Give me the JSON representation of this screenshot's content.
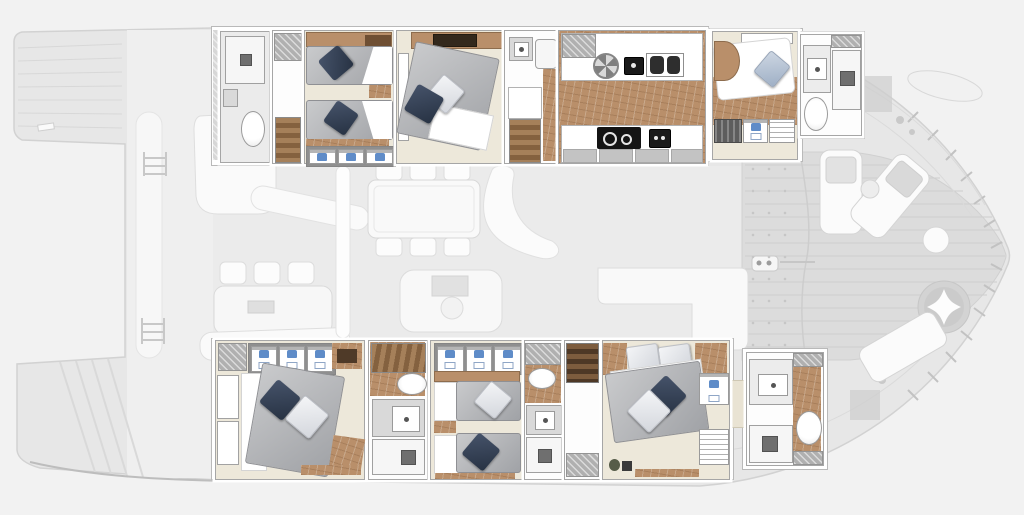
{
  "canvas": {
    "width": 1024,
    "height": 515
  },
  "figure": {
    "kind": "yacht-interior-floor-plan-top-view",
    "vessel": "motor yacht / catamaran deck plan",
    "orientation": "pointed bow at right, wide stern platform at left",
    "highlighted": "cabin-deck strips (upper and lower) rendered in color",
    "ghosted": [
      "stern-platform-wings",
      "side-deck-panel",
      "saloon-deck-center",
      "foredeck-lounge-right"
    ],
    "text_labels": []
  },
  "colors": {
    "background": "#f2f2f2",
    "silhouette": "#e7e7e7",
    "deck_panel": "#efefef",
    "saloon_deck": "#ebebeb",
    "foredeck": "#dcdcdc",
    "ghost_line": "#d2d2d2",
    "ghost_white": "#fafafa",
    "wall": "#a6a6a6",
    "floor_cream": "#ede8da",
    "floor_bath": "#ebebeb",
    "wood": "#b98f6a",
    "wood_dark": "#6f4f33",
    "wood_mid": "#a5805a",
    "sheet": "#ffffff",
    "pillow_dark": "#333e4e",
    "pillow_light": "#e9ebee",
    "pillow_steel": "#b7c3d3",
    "shirt": "#5f8cc8",
    "hatch": "#b0b0b0",
    "appliance": "#1a1a1a",
    "counter_gray": "#c4c4c4",
    "fixture_border": "#9a9a9a"
  },
  "upper_strip": {
    "rooms": [
      {
        "id": "upper-bathroom-fwd",
        "furniture": [
          "shower",
          "washbasin",
          "toilet"
        ]
      },
      {
        "id": "upper-locker-stairs",
        "furniture": [
          "vent-locker",
          "staircase"
        ]
      },
      {
        "id": "upper-twin-cabin",
        "furniture": [
          "headboard-shelf",
          "single-bed",
          "single-bed",
          "nightstand",
          "wardrobe-3-shirts"
        ]
      },
      {
        "id": "upper-double-cabin",
        "furniture": [
          "shelf",
          "tv-unit",
          "window",
          "double-bed",
          "pillows"
        ]
      },
      {
        "id": "upper-shower-stairs",
        "furniture": [
          "washbasin",
          "shower-tray",
          "landing",
          "staircase"
        ]
      },
      {
        "id": "galley",
        "furniture": [
          "worktop",
          "extractor-fan",
          "small-appliance",
          "double-sink",
          "cooktop",
          "oven",
          "cabinet-fronts",
          "wood-floor"
        ]
      },
      {
        "id": "upper-aft-cabin",
        "furniture": [
          "window",
          "double-bed",
          "headboard",
          "dark-locker",
          "shirt-locker",
          "shelf-locker",
          "wood-floor"
        ]
      },
      {
        "id": "upper-aft-bathroom",
        "furniture": [
          "washbasin",
          "toilet",
          "shower"
        ]
      }
    ]
  },
  "lower_strip": {
    "rooms": [
      {
        "id": "owner-cabin",
        "furniture": [
          "vent-locker",
          "wardrobe-3-shirts",
          "wood-cabinet",
          "hull-window",
          "hull-window",
          "double-bed",
          "pillows",
          "desk"
        ]
      },
      {
        "id": "lower-mid-bathroom",
        "furniture": [
          "staircase",
          "toilet",
          "washbasin",
          "shower"
        ]
      },
      {
        "id": "lower-twin-cabin",
        "furniture": [
          "wardrobe-3-shirts",
          "headboard-shelf",
          "single-bed",
          "single-bed",
          "nightstand"
        ]
      },
      {
        "id": "lower-ensuite-wc",
        "furniture": [
          "vent-locker",
          "toilet",
          "washbasin",
          "shower"
        ]
      },
      {
        "id": "lower-stair-lobby",
        "furniture": [
          "staircase",
          "vent-locker"
        ]
      },
      {
        "id": "lower-aft-cabin",
        "furniture": [
          "double-bed",
          "pillows",
          "shirt-locker",
          "shelf-locker",
          "plant",
          "wood-trim"
        ]
      },
      {
        "id": "lower-aft-bathroom",
        "furniture": [
          "washbasin",
          "shower",
          "toilet"
        ]
      }
    ]
  },
  "saloon_ghost": {
    "items": [
      "corner-sofa",
      "sofa-back-band",
      "dinette-chairs-x3",
      "dinette-table",
      "tablet-device",
      "bench-sofa",
      "coachroof-band",
      "boarding-ladder-fwd",
      "boarding-ladder-aft",
      "windshield-band",
      "dining-table",
      "dining-chairs-x6",
      "entry-steps-curve",
      "helm-console",
      "helm-screen",
      "helm-wheel",
      "l-sofa"
    ]
  },
  "foredeck_ghost": {
    "items": [
      "deck-planks",
      "anchor-dots-field",
      "deck-seam",
      "cleat-with-line",
      "sun-lounger-straight",
      "sun-lounger-angled",
      "side-table",
      "pouf",
      "round-chair-star-cushion",
      "sun-lounger-aft",
      "edge-hatch-marks"
    ]
  },
  "stern_ghost": {
    "items": [
      "port-platform-wing",
      "starboard-platform-wing",
      "platform-steps",
      "cleat",
      "transom-edge"
    ]
  },
  "hull_ghost": {
    "items": [
      "deck-hatch-square-top",
      "winch-circles",
      "tender-dinghy",
      "deck-hatch-square-bottom"
    ]
  }
}
